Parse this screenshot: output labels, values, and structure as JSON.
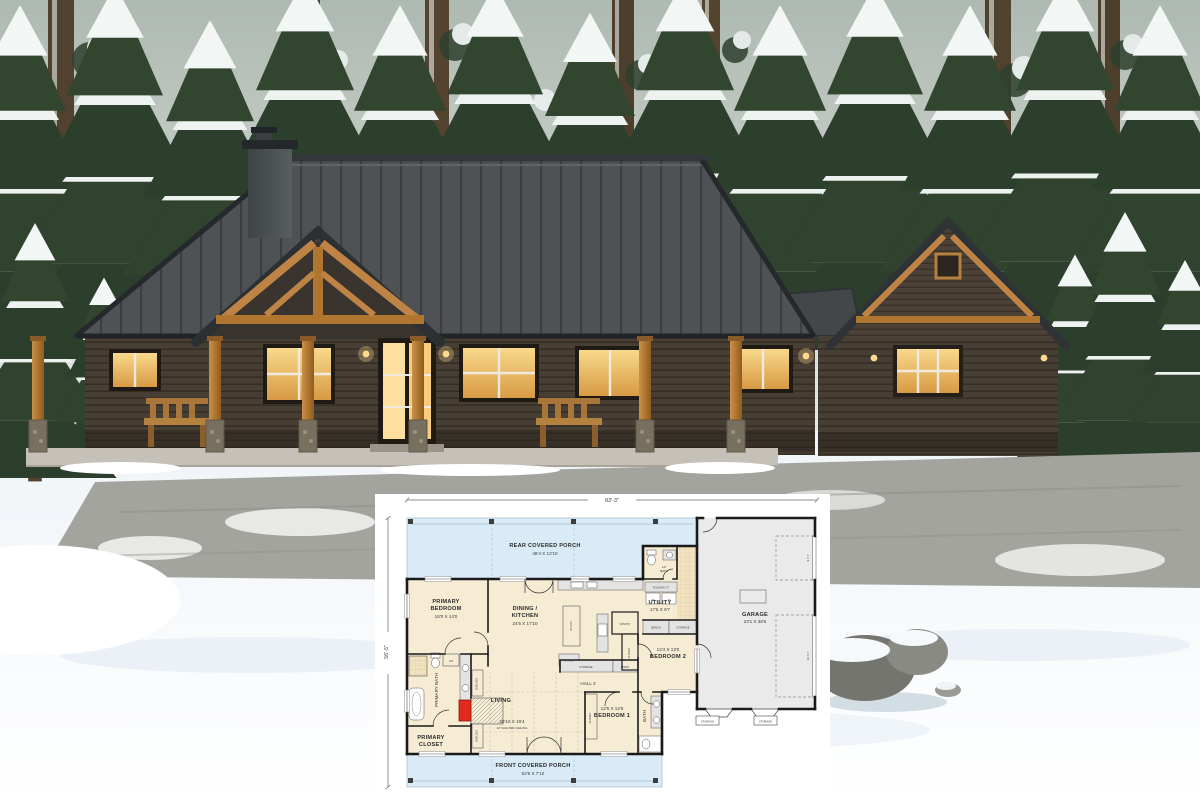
{
  "floor_plan": {
    "overall": {
      "width_label": "83'-3\"",
      "depth_label": "56'-5\""
    },
    "rear_porch": {
      "line1": "REAR COVERED PORCH",
      "line2": "48'4 X 12'10"
    },
    "front_porch": {
      "line1": "FRONT COVERED PORCH",
      "line2": "52'8 X 7'10"
    },
    "garage": {
      "line1": "GARAGE",
      "line2": "23'1 X 38'6",
      "door_small": "9 X 7",
      "door_large": "12 X 7",
      "storage1": "STORAGE",
      "storage2": "STORAGE"
    },
    "primary_bedroom": {
      "line1": "PRIMARY",
      "line2": "BEDROOM",
      "line3": "16'0 X 14'0"
    },
    "dining_kitchen": {
      "line1": "DINING /",
      "line2": "KITCHEN",
      "line3": "24'5 X 17'10",
      "island": "42 X 8'7",
      "fridge": "W/ REF"
    },
    "living": {
      "line1": "LIVING",
      "line2": "20'10 X 16'4",
      "line3": "13' VAULTED CEILING"
    },
    "bedroom1": {
      "line1": "12'5 X 12'6",
      "line2": "BEDROOM 1",
      "closet": "CLOSET"
    },
    "bedroom2": {
      "line1": "12'4 X 13'0",
      "line2": "BEDROOM 2",
      "closet": "CLOSET"
    },
    "bath": {
      "label": "BATH"
    },
    "half_bath": {
      "line1": "1/2",
      "line2": "BATH"
    },
    "utility": {
      "line1": "UTILITY",
      "line2": "17'5 X 6'7",
      "bench": "BENCH",
      "storage": "STORAGE",
      "folding": "FOLDING CT",
      "washer": "W",
      "dryer": "D"
    },
    "hall": {
      "label": "HALL 2"
    },
    "storage_row": {
      "storage": "STORAGE",
      "linen": "LINEN"
    },
    "pantry": {
      "label": "PANTRY"
    },
    "primary_bath": {
      "label": "PRIMARY BATH",
      "linen": "LIN"
    },
    "primary_closet": {
      "line1": "PRIMARY",
      "line2": "CLOSET",
      "shelves1": "SHELVES",
      "shelves2": "SHELVES"
    },
    "colors": {
      "interior": "#f6ecd4",
      "porch": "#d9ebf7",
      "garage_fill": "#eaeaea",
      "wall": "#1a1a1a",
      "fireplace": "#e02a1d",
      "tile": "#efe0bc"
    }
  }
}
